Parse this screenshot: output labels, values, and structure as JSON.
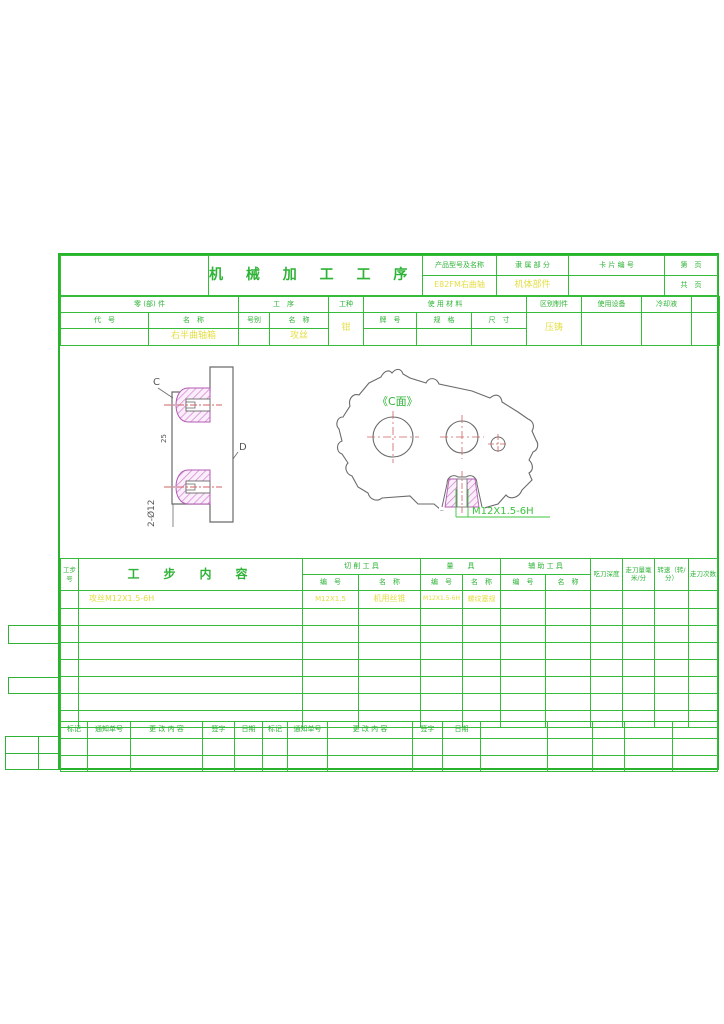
{
  "colors": {
    "grid_green": "#35bd39",
    "text_green": "#2eb336",
    "value_yellow": "#e4de45",
    "hatch_magenta": "#c96ec9",
    "centerline_red": "#d06262",
    "outline_gray": "#6a6a6a"
  },
  "header": {
    "title": "机 械 加 工 工 序 卡 片",
    "product_label": "产品型号及名称",
    "product_value": "E82FM右曲轴",
    "belong_label": "隶 属 部 分",
    "belong_value": "机体部件",
    "card_no_label": "卡 片 编 号",
    "card_no_value": "",
    "page_label": "第　页",
    "total_page_label": "共　页",
    "part_label": "零 (部) 件",
    "process_label": "工　序",
    "worktype_label": "工种",
    "worktype_value": "钳",
    "material_label": "使 用 材 料",
    "code_label": "代　号",
    "name_label": "名　称",
    "no_label": "号别",
    "part_name_value": "右半曲轴箱",
    "process_name_value": "攻丝",
    "brand_label": "牌　号",
    "spec_label": "规　格",
    "size_label": "尺　寸",
    "distinguish_label": "区别制件",
    "distinguish_value": "压铸",
    "equipment_label": "使用设备",
    "coolant_label": "冷却液"
  },
  "drawing": {
    "label_c": "C",
    "label_d": "D",
    "dim_holes": "2-Ø12",
    "dim_depth": "25",
    "view_label": "《C面》",
    "thread_callout": "M12X1.5-6H"
  },
  "steps_table": {
    "step_no_label": "工步号",
    "content_label": "工　步　内　容",
    "cutting_tool_label": "切 削 工 具",
    "gauge_label": "量　　具",
    "aux_tool_label": "辅 助 工 具",
    "bianhao_label": "编　号",
    "mingcheng_label": "名　称",
    "depth_label": "吃刀深度",
    "feed_label": "走刀量毫米/分",
    "speed_label": "转速（转/分）",
    "passes_label": "走刀次数",
    "rows": [
      {
        "content": "攻丝M12X1.5-6H",
        "cut_no": "M12X1.5",
        "cut_name": "机用丝锥",
        "gauge_no": "M12X1.5-6H",
        "gauge_name": "螺纹塞规"
      }
    ]
  },
  "footer": {
    "mark_label": "标记",
    "notice_label": "通知单号",
    "change_label": "更 改 内 容",
    "sign_label": "签字",
    "date_label": "日期"
  }
}
